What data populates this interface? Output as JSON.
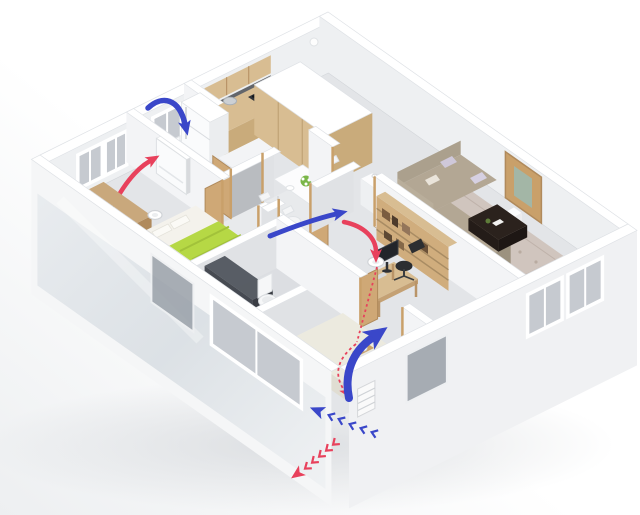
{
  "scene": {
    "description": "Isometric 3D dollhouse cutaway of an apartment illustrating a fresh-air heat-recovery ventilation system",
    "view": "isometric cutaway render",
    "background": "#ffffff"
  },
  "colors": {
    "supply_air": "#3a47c9",
    "exhaust_air": "#e8415c",
    "wall_top": "#ffffff",
    "wall_face_light": "#f3f4f6",
    "wall_face_shade": "#e0e2e5",
    "floor": "#e3e5e8",
    "wood": "#d0ad7d",
    "wood_dark": "#b08a5c",
    "glass": "#c6cad0",
    "sofa": "#b3a794",
    "rug": "#cfc3bc",
    "bed_blanket": "#b6d845",
    "coffee_table": "#2b221d",
    "shower_glass": "#31363d",
    "shadow": "#c4c8cd"
  },
  "rooms": [
    {
      "id": "master-bedroom",
      "label": "Master bedroom",
      "furniture": [
        "double bed with green blanket",
        "wardrobe",
        "wall ventilation unit",
        "ceiling extract valve",
        "two windows"
      ]
    },
    {
      "id": "bathroom-small",
      "label": "Small bathroom",
      "furniture": [
        "window",
        "radiator",
        "open door"
      ]
    },
    {
      "id": "bathroom-main",
      "label": "Bathroom",
      "furniture": [
        "shower enclosure",
        "toilet"
      ]
    },
    {
      "id": "kitchen",
      "label": "Kitchen",
      "furniture": [
        "fridge",
        "counter with sink and hob",
        "upper cabinets",
        "kettle"
      ]
    },
    {
      "id": "dining",
      "label": "Dining corner",
      "furniture": [
        "white table",
        "three chairs",
        "flower bouquet"
      ]
    },
    {
      "id": "hallway",
      "label": "Hallway",
      "furniture": [
        "open doors",
        "air transfer arrow"
      ]
    },
    {
      "id": "entrance",
      "label": "Entrance",
      "furniture": [
        "built-in closet",
        "front door with glass inset",
        "shoe bench"
      ]
    },
    {
      "id": "living-room",
      "label": "Living room",
      "furniture": [
        "corner sofa with pillows",
        "dark coffee table",
        "floral rug",
        "side table",
        "two windows"
      ]
    },
    {
      "id": "study",
      "label": "Study",
      "furniture": [
        "desk with monitor",
        "desk chair",
        "office chair",
        "bookshelf",
        "ceiling extract valve"
      ]
    },
    {
      "id": "bedroom-2",
      "label": "Second bedroom",
      "furniture": [
        "bed with wooden tray",
        "large front window"
      ]
    }
  ],
  "ventilation": {
    "system": "wall-mounted heat-recovery fresh air unit with exterior wall vent",
    "flows": [
      {
        "id": "bedroom-supply",
        "type": "supply",
        "description": "fresh air arcing over wall into unit"
      },
      {
        "id": "bedroom-exhaust",
        "type": "exhaust",
        "description": "stale air drawn up into wall unit"
      },
      {
        "id": "hallway-transfer",
        "type": "supply",
        "description": "air transfer through hallway door"
      },
      {
        "id": "study-supply",
        "type": "supply",
        "description": "fresh air rising from corner vent"
      },
      {
        "id": "study-exhaust",
        "type": "exhaust",
        "description": "extract via ceiling valve and duct to facade vent"
      },
      {
        "id": "outdoor-intake",
        "type": "supply",
        "description": "outdoor air chevrons entering wall vent"
      },
      {
        "id": "outdoor-exhaust",
        "type": "exhaust",
        "description": "exhaust chevrons leaving wall vent"
      }
    ]
  }
}
